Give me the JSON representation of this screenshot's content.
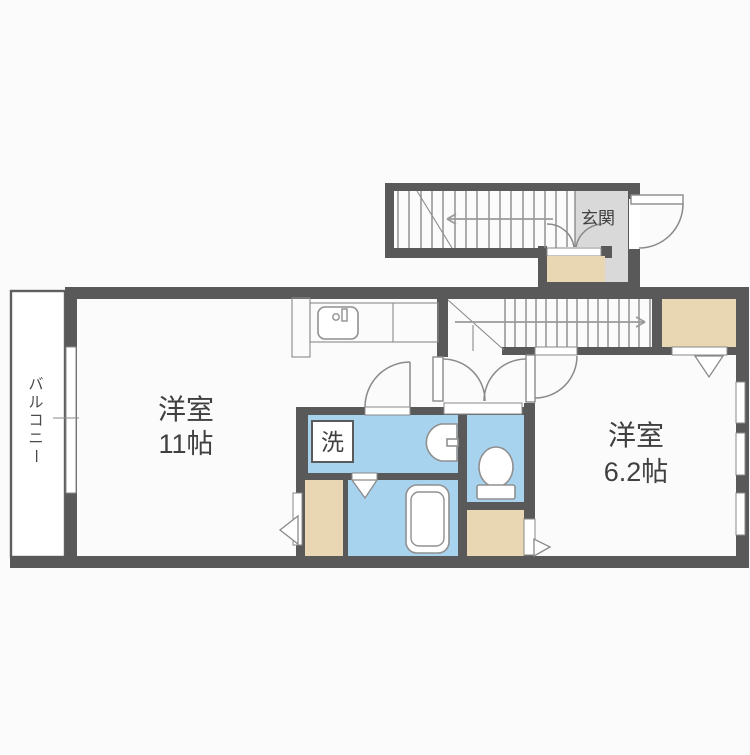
{
  "palette": {
    "wall": "#595959",
    "line": "#8a8a8a",
    "water_blue": "#a8d3ee",
    "closet_tan": "#e9d6b2",
    "entrance_gray": "#d9d9d9",
    "background": "#fbfbfb",
    "text": "#404040"
  },
  "labels": {
    "entrance": "玄関",
    "room_large_name": "洋室",
    "room_large_size": "11帖",
    "room_small_name": "洋室",
    "room_small_size": "6.2帖",
    "laundry": "洗",
    "balcony": "バルコニー",
    "balcony_chars": [
      "バ",
      "ル",
      "コ",
      "ニ",
      "ー"
    ]
  },
  "rooms": [
    {
      "name": "洋室",
      "size": "11帖"
    },
    {
      "name": "洋室",
      "size": "6.2帖"
    },
    {
      "name": "玄関",
      "size": ""
    },
    {
      "name": "バルコニー",
      "size": ""
    }
  ],
  "icons": [
    "kitchen-sink-icon",
    "washbasin-icon",
    "toilet-icon",
    "bathtub-icon",
    "washing-machine-icon",
    "stairs-up-arrow-icon",
    "stairs-down-arrow-icon",
    "door-swing-icon",
    "folding-door-icon",
    "window-icon"
  ]
}
